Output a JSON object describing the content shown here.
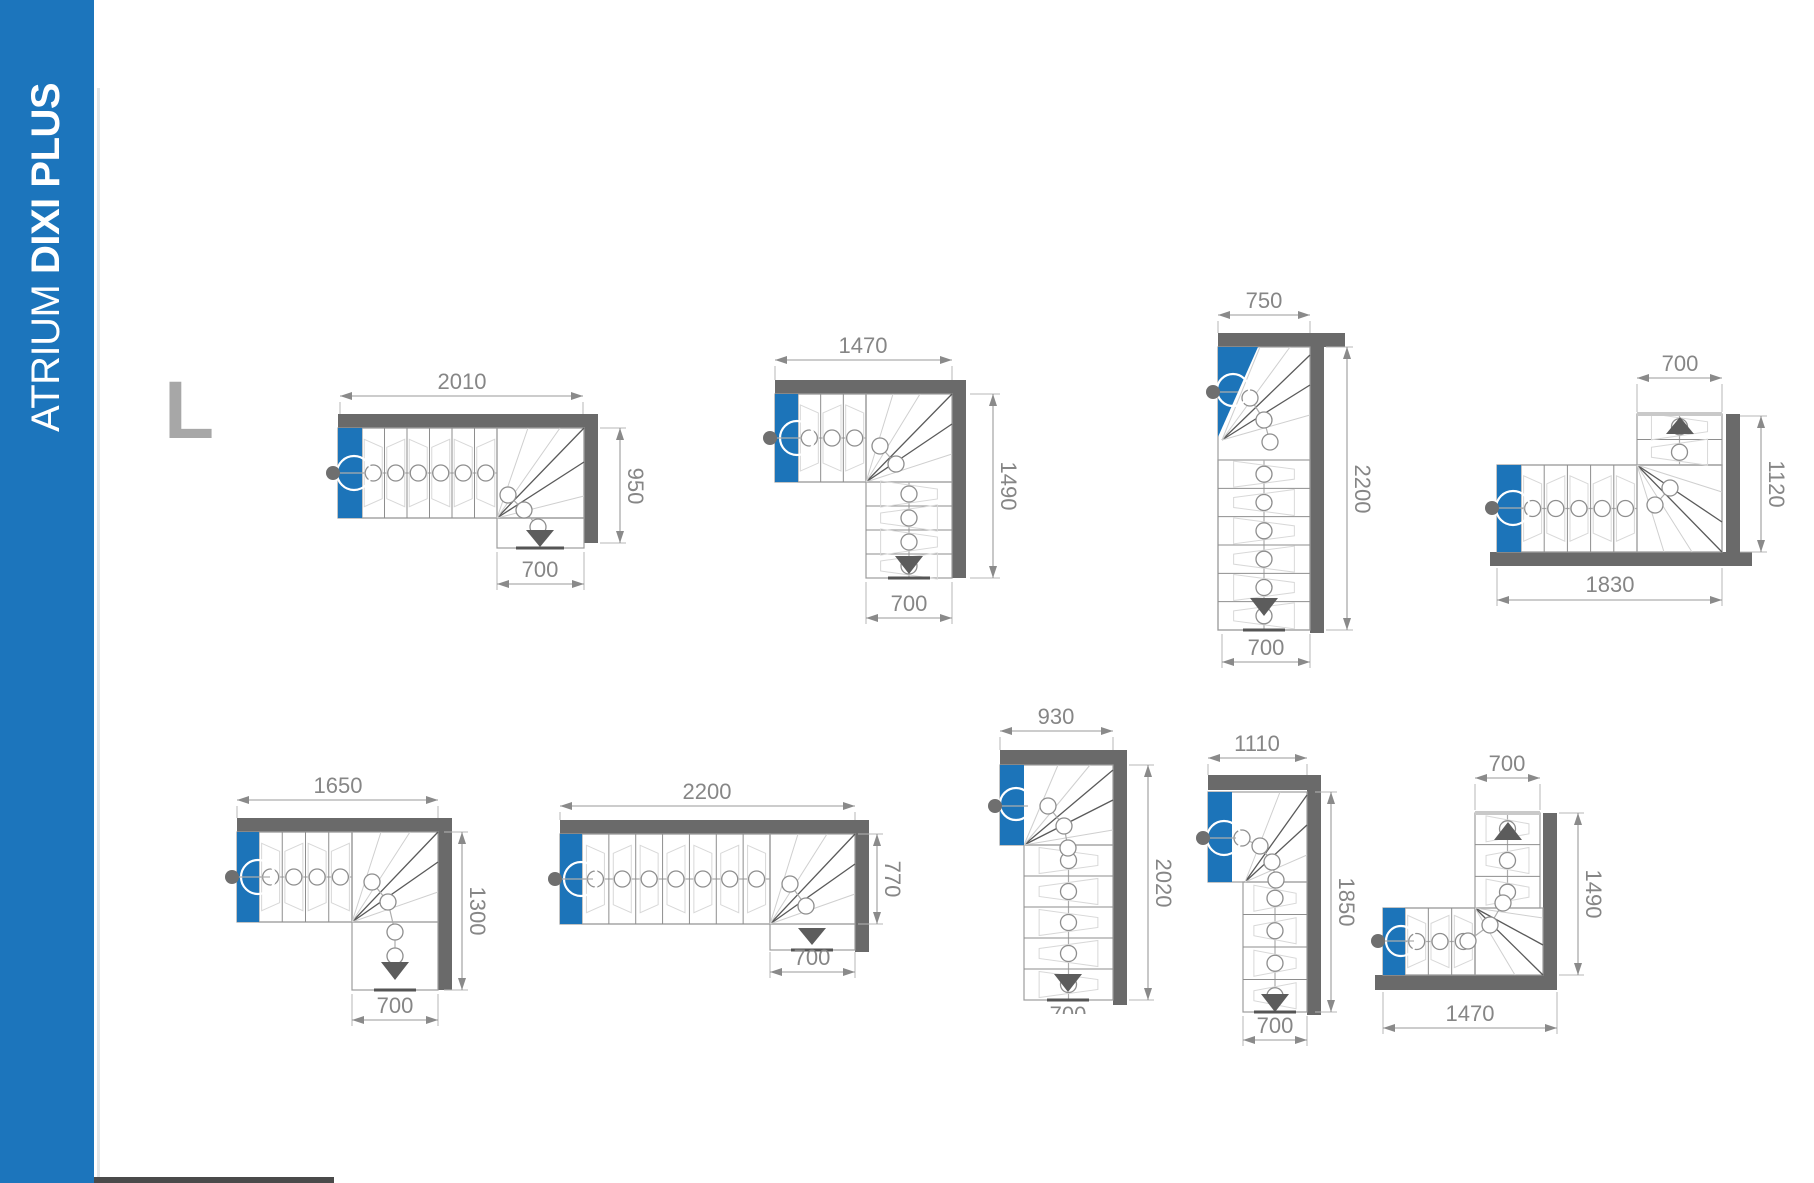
{
  "sidebar": {
    "brand_regular": "ATRIUM",
    "brand_bold": "DIXI PLUS"
  },
  "category": {
    "letter": "L"
  },
  "colors": {
    "accent_blue": "#1c74b9",
    "wall_gray": "#6a6a6a",
    "dim_text_gray": "#868686",
    "letter_gray": "#a7a7a7"
  },
  "diagrams": [
    {
      "position": "row-1-col-1",
      "shape": "L: entry left, run right, exit down",
      "dims": {
        "top": "2010",
        "right": "950",
        "bottom": "700"
      }
    },
    {
      "position": "row-1-col-2",
      "shape": "L: entry left, run right, exit down",
      "dims": {
        "top": "1470",
        "right": "1490",
        "bottom": "700"
      }
    },
    {
      "position": "row-1-col-3",
      "shape": "L: entry top-left, long run down",
      "dims": {
        "top": "750",
        "right": "2200",
        "bottom": "700"
      }
    },
    {
      "position": "row-1-col-4",
      "shape": "L: entry left, run right, exit up",
      "dims": {
        "top": "700",
        "right": "1120",
        "bottom": "1830"
      }
    },
    {
      "position": "row-2-col-1",
      "shape": "L: entry left, run right, exit down",
      "dims": {
        "top": "1650",
        "right": "1300",
        "bottom": "700"
      }
    },
    {
      "position": "row-2-col-2",
      "shape": "L: entry left, long run right, exit down",
      "dims": {
        "top": "2200",
        "right": "770",
        "bottom": "700"
      }
    },
    {
      "position": "row-2-col-3",
      "shape": "L: entry left, long run down",
      "bottom_label_clipped": true,
      "dims": {
        "top": "930",
        "right": "2020",
        "bottom": "700"
      }
    },
    {
      "position": "row-2-col-4",
      "shape": "L: entry left, long run down",
      "dims": {
        "top": "1110",
        "right": "1850",
        "bottom": "700"
      }
    },
    {
      "position": "row-2-col-5",
      "shape": "L: entry left, run right, exit up",
      "dims": {
        "top": "700",
        "right": "1490",
        "bottom": "1470"
      }
    }
  ]
}
